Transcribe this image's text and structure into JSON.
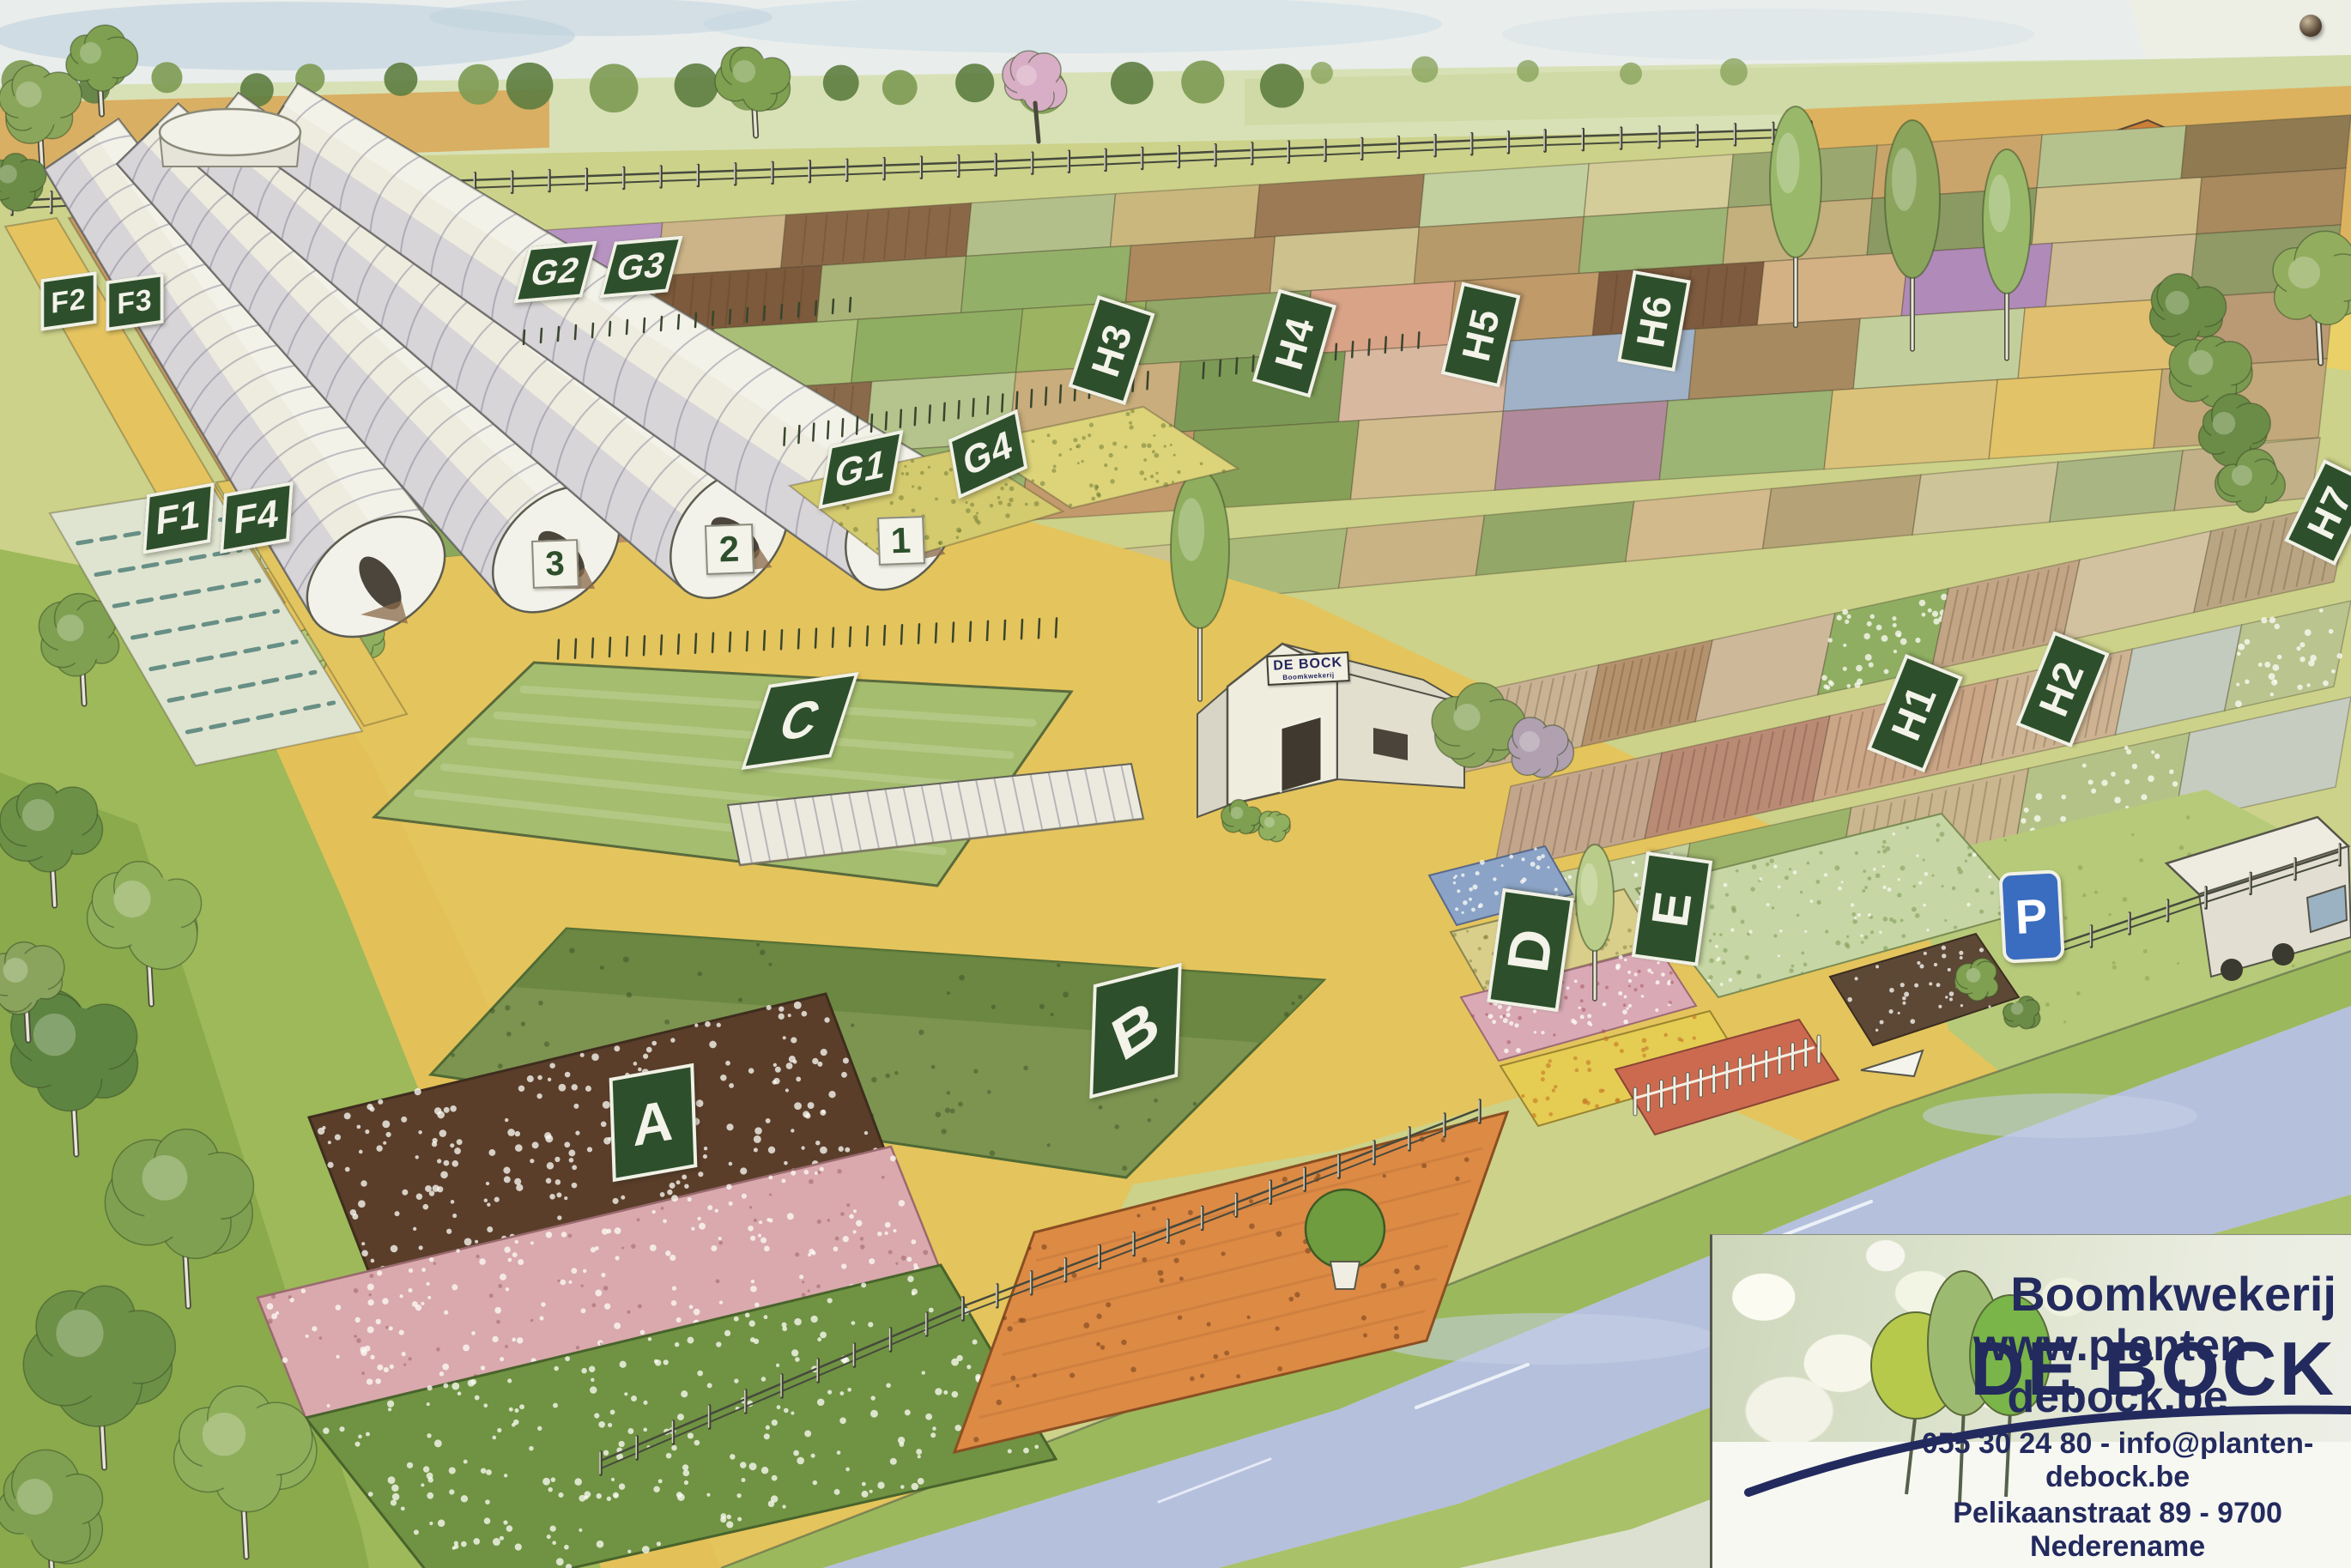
{
  "map": {
    "region_labels": [
      {
        "id": "F1",
        "text": "F1"
      },
      {
        "id": "F2",
        "text": "F2"
      },
      {
        "id": "F3",
        "text": "F3"
      },
      {
        "id": "F4",
        "text": "F4"
      },
      {
        "id": "G1",
        "text": "G1"
      },
      {
        "id": "G2",
        "text": "G2"
      },
      {
        "id": "G3",
        "text": "G3"
      },
      {
        "id": "G4",
        "text": "G4"
      },
      {
        "id": "H1",
        "text": "H1"
      },
      {
        "id": "H2",
        "text": "H2"
      },
      {
        "id": "H3",
        "text": "H3"
      },
      {
        "id": "H4",
        "text": "H4"
      },
      {
        "id": "H5",
        "text": "H5"
      },
      {
        "id": "H6",
        "text": "H6"
      },
      {
        "id": "H7",
        "text": "H7"
      },
      {
        "id": "A",
        "text": "A"
      },
      {
        "id": "B",
        "text": "B"
      },
      {
        "id": "C",
        "text": "C"
      },
      {
        "id": "D",
        "text": "D"
      },
      {
        "id": "E",
        "text": "E"
      }
    ],
    "greenhouse_numbers": [
      {
        "id": "gh1",
        "text": "1"
      },
      {
        "id": "gh2",
        "text": "2"
      },
      {
        "id": "gh3",
        "text": "3"
      }
    ],
    "parking": {
      "id": "P",
      "text": "P"
    }
  },
  "barn_sign": {
    "line1": "DE BOCK",
    "line2": "Boomkwekerij"
  },
  "logo_card": {
    "company_prefix": "Boomkwekerij",
    "company_name": "DE BOCK",
    "website": "www.planten-debock.be",
    "contact_line": "055 30 24 80 - info@planten-debock.be",
    "address": "Pelikaanstraat 89 - 9700 Nederename"
  },
  "colors": {
    "label_green": "#2d4f2b",
    "label_text": "#f3f3ea",
    "number_badge_bg": "#f3f3ea",
    "number_badge_text": "#2d4f2b",
    "parking_blue": "#3a6cc0",
    "logo_navy": "#232a5e",
    "logo_tree_greens": [
      "#b7c94b",
      "#9dbb70",
      "#79b548"
    ]
  }
}
